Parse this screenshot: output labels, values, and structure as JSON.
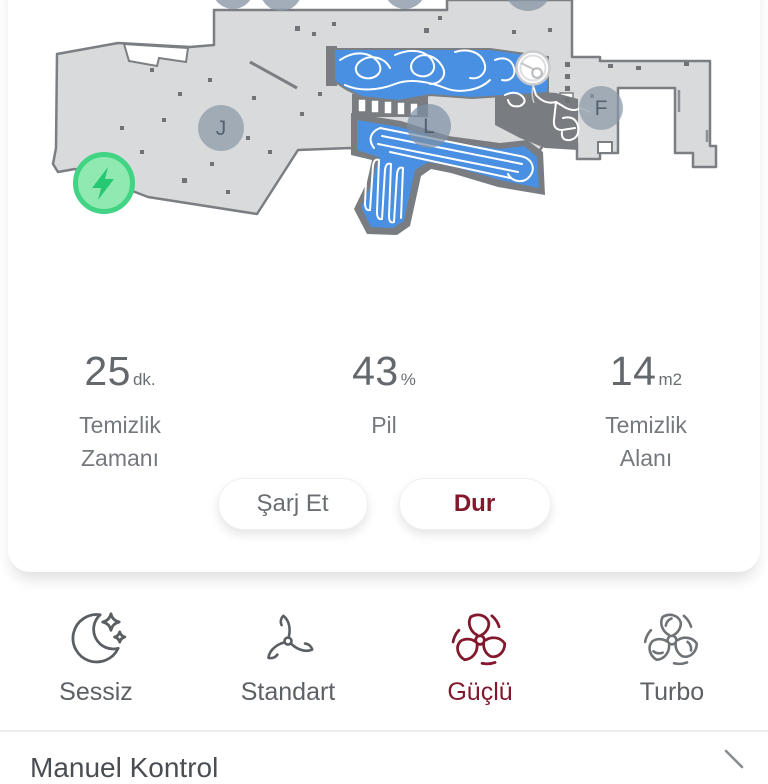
{
  "map": {
    "rooms": [
      {
        "label": "J"
      },
      {
        "label": "L"
      },
      {
        "label": "F"
      }
    ],
    "markers": {
      "charger": "lightning-icon",
      "robot": "robot-icon"
    },
    "colors": {
      "cleaned_area": "#4a90e2",
      "floor": "#d9dadc",
      "walls": "#7a7d81",
      "charger_green": "#42d485"
    }
  },
  "stats": [
    {
      "value": "25",
      "unit": "dk.",
      "label": "Temizlik Zamanı"
    },
    {
      "value": "43",
      "unit": "%",
      "label": "Pil"
    },
    {
      "value": "14",
      "unit": "m2",
      "label": "Temizlik Alanı"
    }
  ],
  "actions": {
    "charge_label": "Şarj Et",
    "stop_label": "Dur"
  },
  "fan_modes": [
    {
      "label": "Sessiz",
      "icon": "moon-sparkles-icon",
      "selected": false
    },
    {
      "label": "Standart",
      "icon": "propeller-icon",
      "selected": false
    },
    {
      "label": "Güçlü",
      "icon": "fan-strong-icon",
      "selected": true
    },
    {
      "label": "Turbo",
      "icon": "fan-turbo-icon",
      "selected": false
    }
  ],
  "bottom": {
    "label": "Manuel Kontrol",
    "chevron": "›"
  },
  "theme": {
    "accent_red": "#83172c",
    "text_primary": "#64686c",
    "text_secondary": "#75797d"
  }
}
